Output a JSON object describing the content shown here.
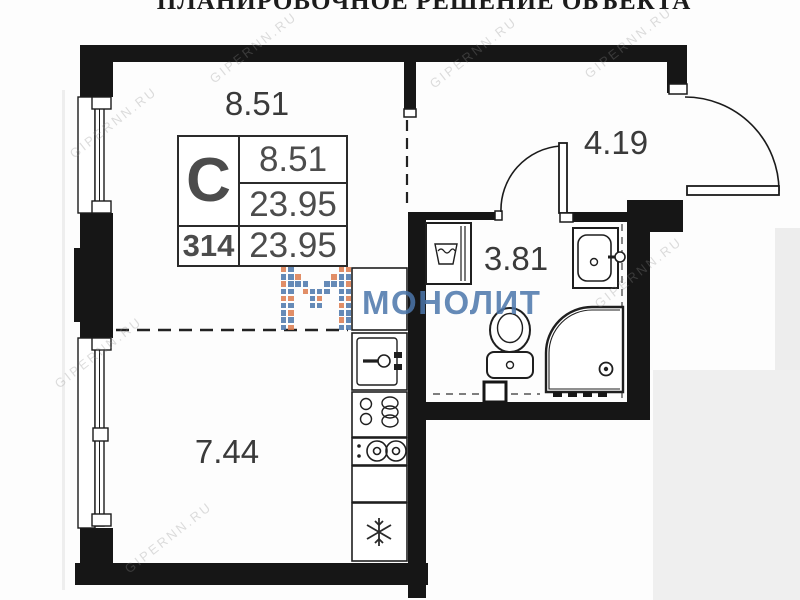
{
  "title": "ПЛАНИРОВОЧНОЕ РЕШЕНИЕ ОБЪЕКТА",
  "spec_table": {
    "type": "С",
    "living_area": "8.51",
    "total_area": "23.95",
    "unit_number": "314",
    "total_area_repeat": "23.95"
  },
  "rooms": {
    "living": "8.51",
    "hallway": "4.19",
    "bathroom": "3.81",
    "sleeping": "7.44"
  },
  "watermarks": {
    "brand": "МОНОЛИТ",
    "site": "GIPERNN.RU"
  },
  "colors": {
    "brand_blue": "#4b76ab",
    "brand_orange": "#dd7b4d",
    "wall_black": "#161616"
  }
}
